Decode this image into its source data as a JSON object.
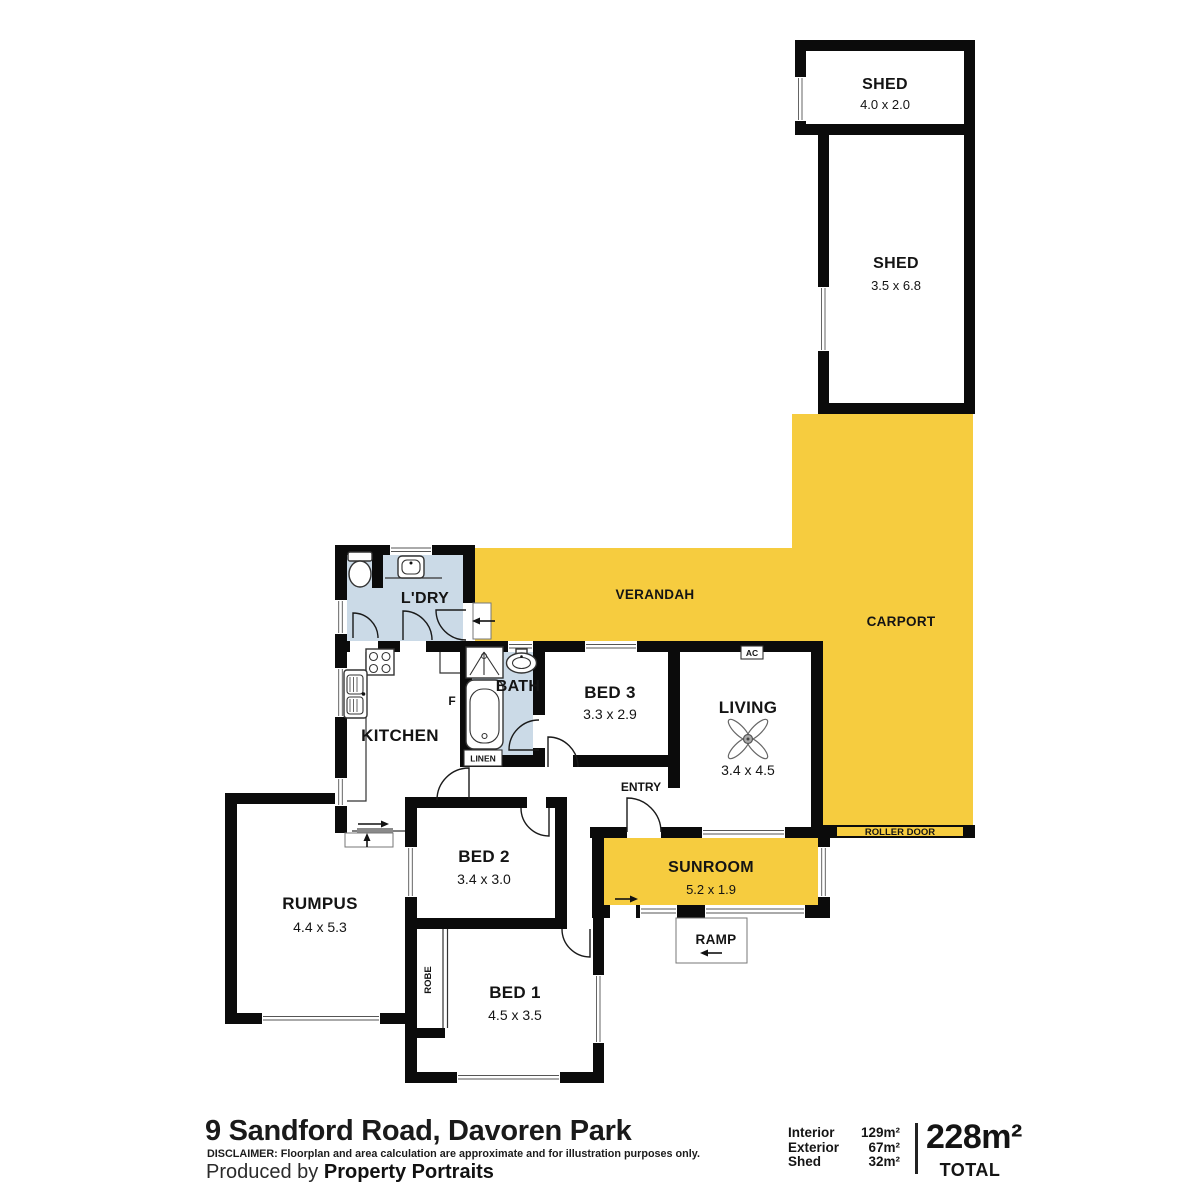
{
  "colors": {
    "accent_yellow": "#F6CC3F",
    "room_blue": "#CBDAE7",
    "wall_black": "#0B0B0B"
  },
  "rooms": {
    "shed_top": {
      "name": "SHED",
      "dims": "4.0 x 2.0"
    },
    "shed_main": {
      "name": "SHED",
      "dims": "3.5 x 6.8"
    },
    "verandah": {
      "name": "VERANDAH"
    },
    "carport": {
      "name": "CARPORT"
    },
    "laundry": {
      "name": "L'DRY"
    },
    "kitchen": {
      "name": "KITCHEN"
    },
    "bath": {
      "name": "BATH"
    },
    "bed3": {
      "name": "BED 3",
      "dims": "3.3 x 2.9"
    },
    "living": {
      "name": "LIVING",
      "dims": "3.4 x 4.5"
    },
    "rumpus": {
      "name": "RUMPUS",
      "dims": "4.4 x 5.3"
    },
    "bed2": {
      "name": "BED 2",
      "dims": "3.4 x 3.0"
    },
    "bed1": {
      "name": "BED 1",
      "dims": "4.5 x 3.5"
    },
    "sunroom": {
      "name": "SUNROOM",
      "dims": "5.2 x 1.9"
    }
  },
  "labels": {
    "entry": "ENTRY",
    "ramp": "RAMP",
    "robe": "ROBE",
    "linen": "LINEN",
    "fridge": "F",
    "ac": "AC",
    "roller_door": "ROLLER DOOR"
  },
  "footer": {
    "address": "9 Sandford Road, Davoren Park",
    "disclaimer_label": "DISCLAIMER:",
    "disclaimer_text": " Floorplan and area calculation are approximate and for illustration purposes only.",
    "produced_by": "Produced by ",
    "producer": "Property Portraits",
    "areas": [
      {
        "label": "Interior",
        "value": "129m²"
      },
      {
        "label": "Exterior",
        "value": "67m²"
      },
      {
        "label": "Shed",
        "value": "32m²"
      }
    ],
    "total_value": "228m²",
    "total_label": "TOTAL"
  }
}
